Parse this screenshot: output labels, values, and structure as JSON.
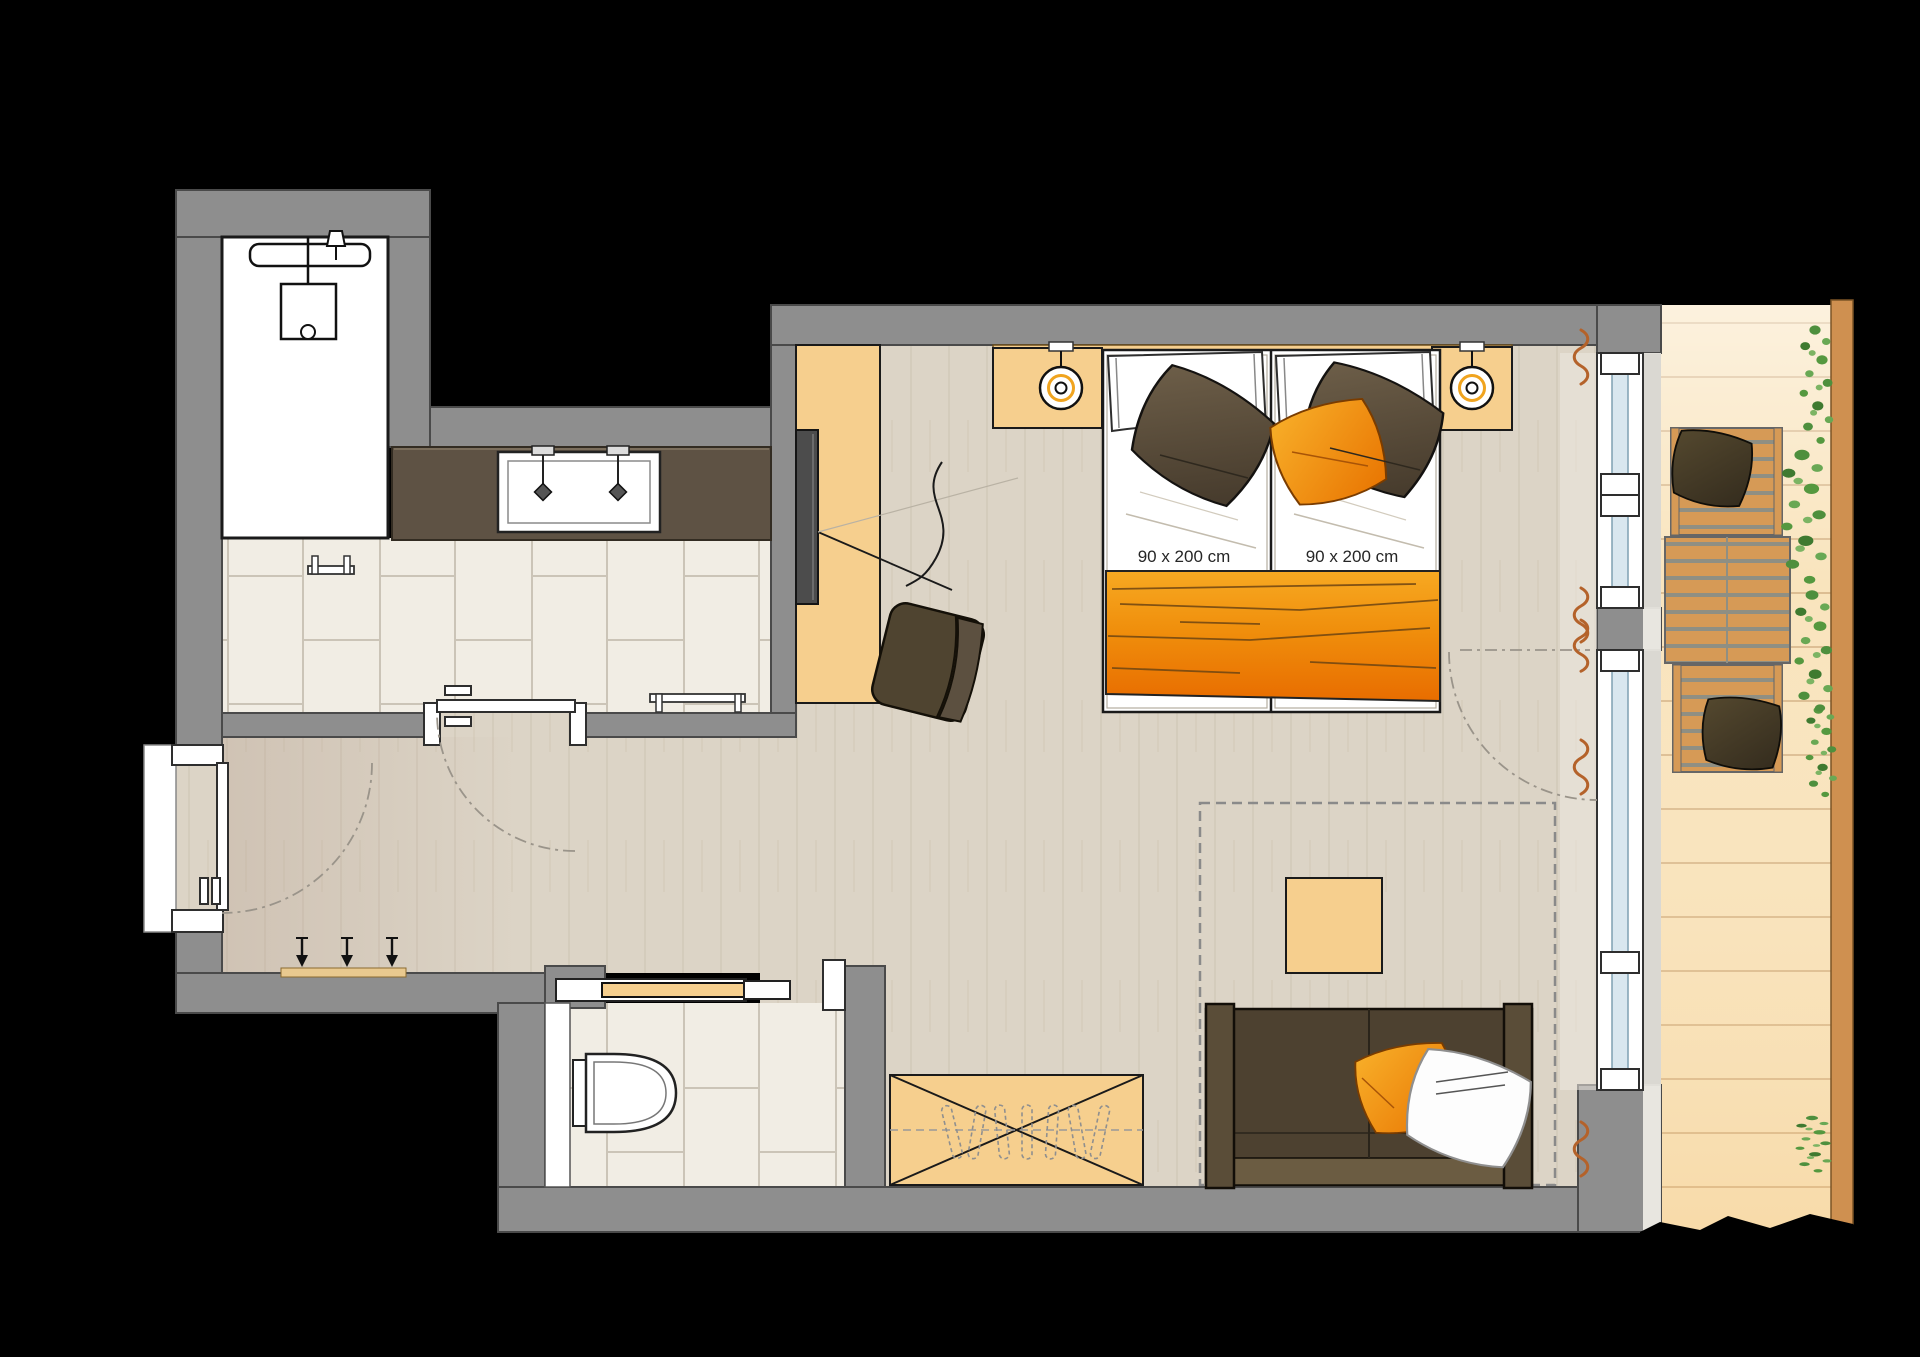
{
  "plan": {
    "kind": "hotel-room-floor-plan",
    "beds": [
      {
        "size_label": "90 x 200 cm"
      },
      {
        "size_label": "90 x 200 cm"
      }
    ],
    "fixtures": [
      "shower-icon",
      "rain-showerhead-icon",
      "double-washbasin-icon",
      "faucet-icon",
      "toilet-icon",
      "towel-rail-icon",
      "coat-hooks-icon",
      "entry-door-icon",
      "bathroom-door-icon",
      "wc-sliding-door-icon",
      "tv-icon",
      "desk-sideboard",
      "desk-chair",
      "nightstand-lamp-icon",
      "single-bed",
      "bed-runner",
      "pillow-icon",
      "wardrobe-cross-icon",
      "clothes-hanger-icon",
      "coffee-table",
      "sofa",
      "carpet-outline",
      "window-glazing",
      "curtain-icon",
      "balcony-chair",
      "balcony-table",
      "balcony-railing",
      "climbing-plants-icon"
    ],
    "colors": {
      "wall": "#8e8e8e",
      "wall_outline": "#4a4a4a",
      "floor_wood": "#dcd4c6",
      "tile": "#f1ede4",
      "grout": "#cbc4b7",
      "furniture_tan": "#f6cf8e",
      "counter_brown": "#5e5244",
      "accent_orange": "#f08f0c",
      "pillow_brown": "#5a4c36",
      "sofa_brown": "#4d4130",
      "balcony_wood": "#d69a56",
      "balcony_floor": "#f9e4bd",
      "railing": "#cf9050",
      "plant_green": "#55983f",
      "curtain_sienna": "#b4622a",
      "glass_blue": "#d9e7ef",
      "arc_gray": "#9a948a",
      "text_dark": "#262626"
    }
  }
}
